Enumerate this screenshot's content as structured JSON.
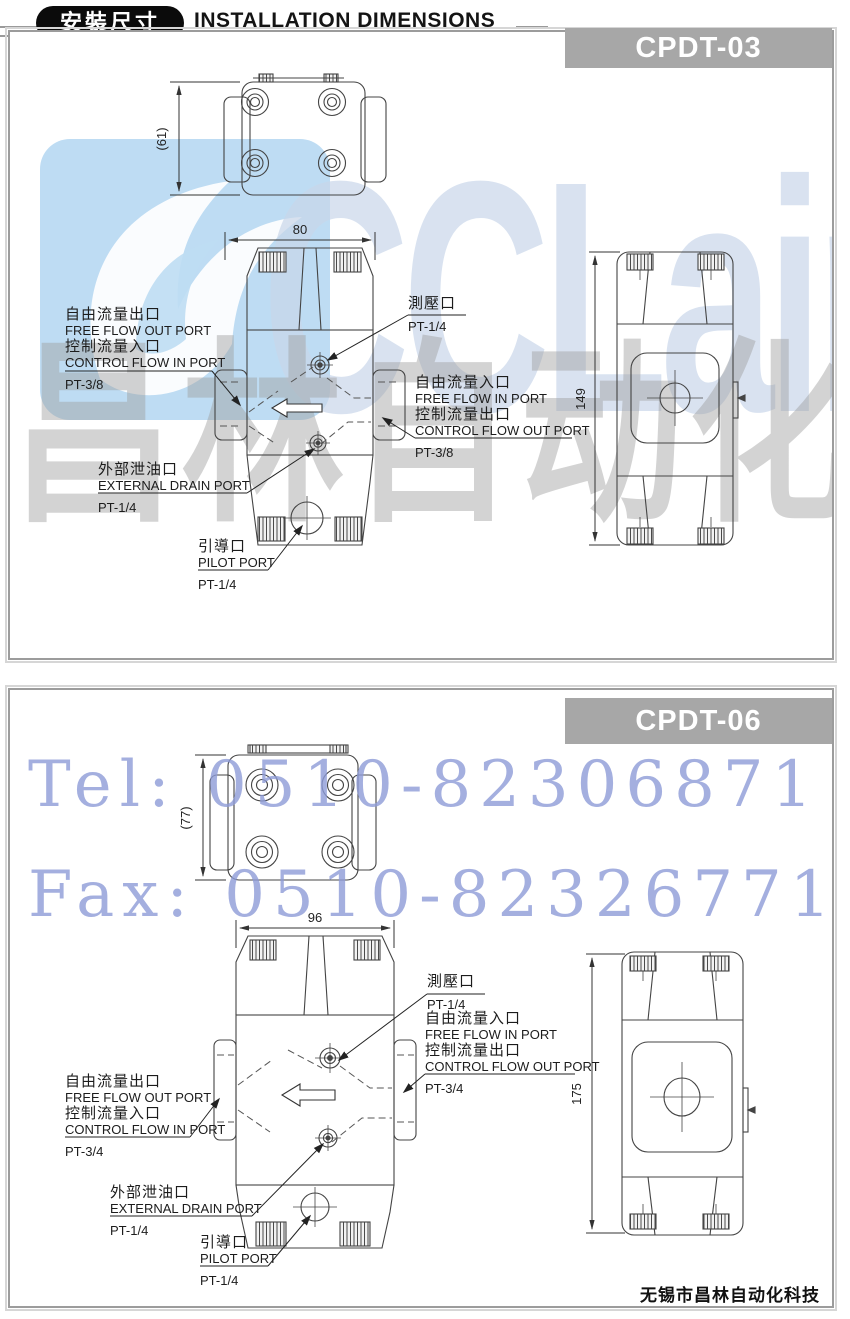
{
  "header": {
    "badge": "安裝尺寸",
    "title": "INSTALLATION DIMENSIONS"
  },
  "watermark": {
    "brand": "CCLair",
    "brand_cn": "昌林自动化",
    "tel": "Tel: 0510-82306871",
    "fax": "Fax: 0510-82326771"
  },
  "footer": {
    "company": "无锡市昌林自动化科技"
  },
  "colors": {
    "banner_gray": "#a7a7a7",
    "logo_blue": "#b7d9f2",
    "watermark_blue": "#8e9cd8",
    "header_black": "#0b0b0b"
  },
  "panels": [
    {
      "model": "CPDT-03",
      "dims": {
        "top_view_height": "(61)",
        "front_width": "80",
        "side_height": "149"
      },
      "labels": {
        "free_flow_out_cn": "自由流量出口",
        "free_flow_out_en": "FREE FLOW OUT PORT",
        "control_flow_in_cn": "控制流量入口",
        "control_flow_in_en": "CONTROL FLOW IN PORT",
        "in_port_size": "PT-3/8",
        "gauge_cn": "測壓口",
        "gauge_size": "PT-1/4",
        "free_flow_in_cn": "自由流量入口",
        "free_flow_in_en": "FREE FLOW IN PORT",
        "control_flow_out_cn": "控制流量出口",
        "control_flow_out_en": "CONTROL FLOW OUT PORT",
        "out_port_size": "PT-3/8",
        "drain_cn": "外部泄油口",
        "drain_en": "EXTERNAL DRAIN PORT",
        "drain_size": "PT-1/4",
        "pilot_cn": "引導口",
        "pilot_en": "PILOT PORT",
        "pilot_size": "PT-1/4"
      }
    },
    {
      "model": "CPDT-06",
      "dims": {
        "top_view_height": "(77)",
        "front_width": "96",
        "side_height": "175"
      },
      "labels": {
        "free_flow_out_cn": "自由流量出口",
        "free_flow_out_en": "FREE FLOW OUT PORT",
        "control_flow_in_cn": "控制流量入口",
        "control_flow_in_en": "CONTROL FLOW IN PORT",
        "in_port_size": "PT-3/4",
        "gauge_cn": "測壓口",
        "gauge_size": "PT-1/4",
        "free_flow_in_cn": "自由流量入口",
        "free_flow_in_en": "FREE FLOW IN PORT",
        "control_flow_out_cn": "控制流量出口",
        "control_flow_out_en": "CONTROL FLOW OUT PORT",
        "out_port_size": "PT-3/4",
        "drain_cn": "外部泄油口",
        "drain_en": "EXTERNAL DRAIN PORT",
        "drain_size": "PT-1/4",
        "pilot_cn": "引導口",
        "pilot_en": "PILOT PORT",
        "pilot_size": "PT-1/4"
      }
    }
  ]
}
